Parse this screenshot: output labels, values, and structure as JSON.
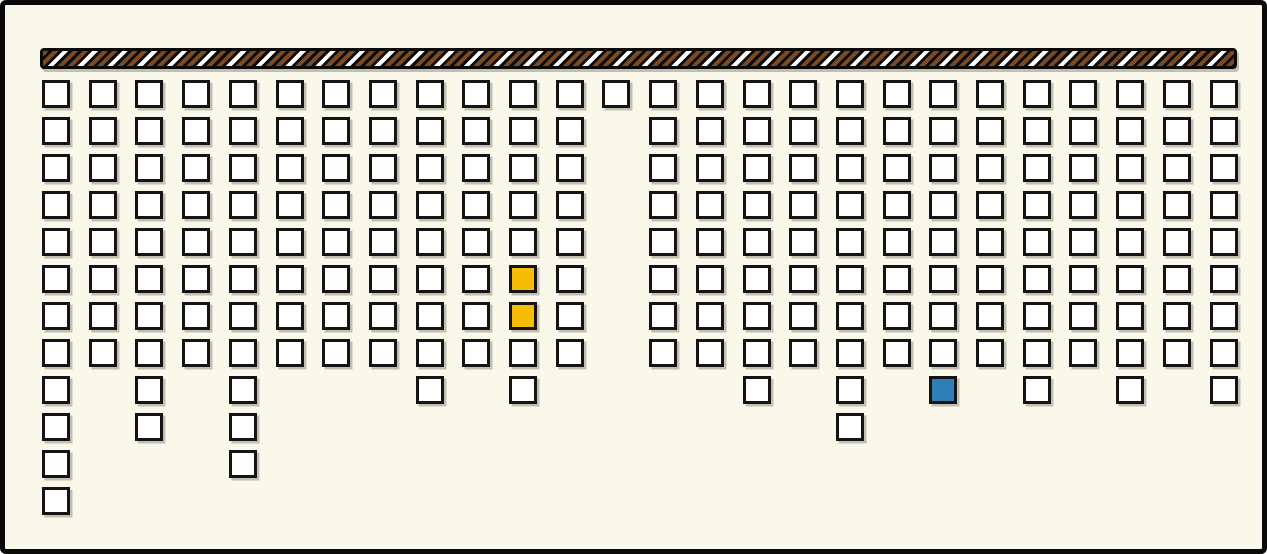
{
  "window": {
    "width": 1267,
    "height": 554,
    "background": "#faf8ea",
    "frame_border_color": "#0a0a0a"
  },
  "rod": {
    "x": 35,
    "y": 43,
    "width": 1197,
    "height": 21,
    "base_color": "#0a0a0a",
    "stripe_brown": "#7b4a21",
    "stripe_white": "#ffffff",
    "stripe_direction_deg": 135,
    "stripe_widths": {
      "color_band": 4,
      "black_gap": 3
    }
  },
  "grid": {
    "origin_x": 37,
    "origin_y": 75,
    "col_pitch": 46.7,
    "row_pitch": 37,
    "cell_size": 28,
    "cell_fill": "#ffffff",
    "cell_border_color": "#141414",
    "shadow_color": "rgba(125,122,108,0.45)",
    "num_columns": 26,
    "column_heights": [
      12,
      8,
      10,
      8,
      11,
      8,
      8,
      8,
      9,
      8,
      9,
      8,
      1,
      8,
      8,
      9,
      8,
      10,
      8,
      9,
      8,
      9,
      8,
      9,
      8,
      9
    ],
    "highlight_cells": [
      {
        "col": 10,
        "row": 6,
        "color_name": "yellow",
        "fill": "#f7bd06"
      },
      {
        "col": 10,
        "row": 7,
        "color_name": "yellow",
        "fill": "#f7bd06"
      },
      {
        "col": 19,
        "row": 9,
        "color_name": "blue",
        "fill": "#2e7fb8"
      }
    ]
  }
}
